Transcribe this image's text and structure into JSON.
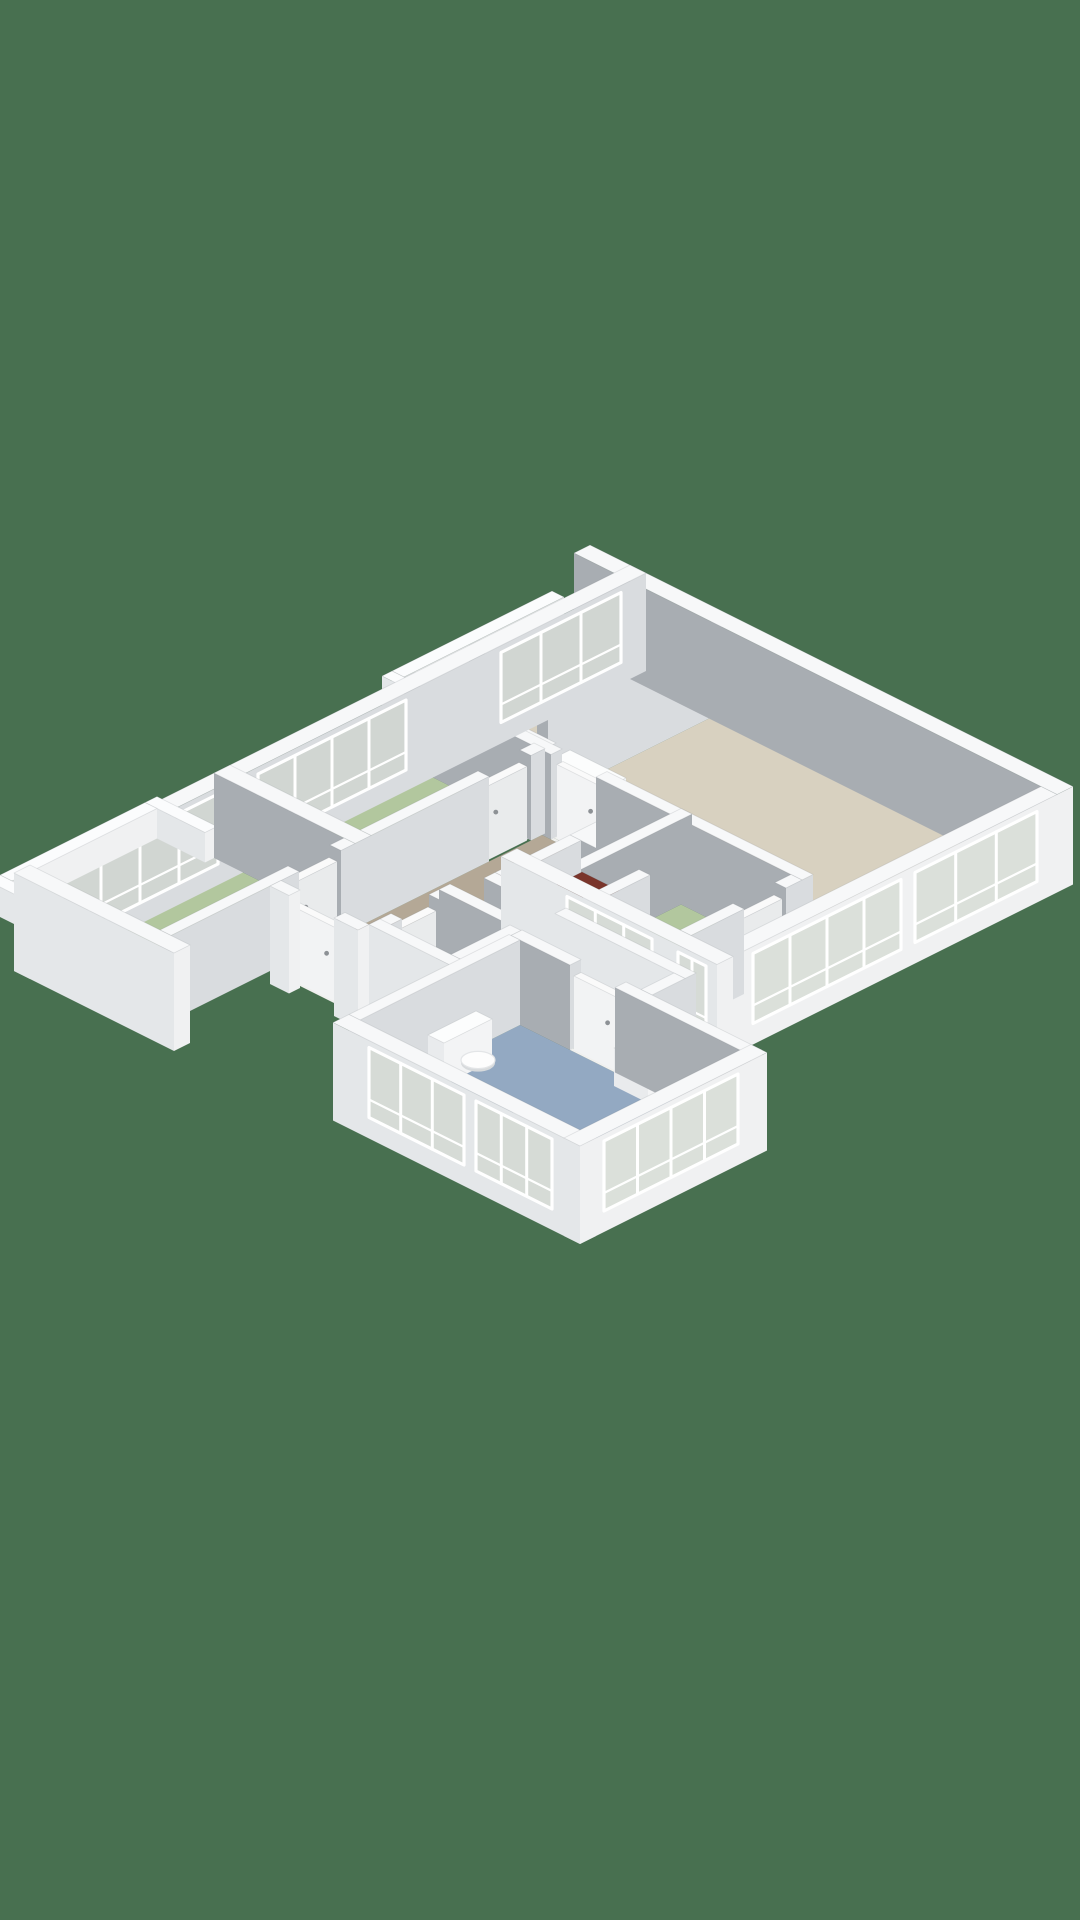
{
  "meta": {
    "type": "3d-isometric-floorplan-render",
    "description": "Top-down axonometric 3D floor plan of an apartment on a solid green background. No text labels are visible in the image."
  },
  "palette": {
    "background": "#487050",
    "floorBeige": "#d8d1c0",
    "floorTaupe": "#b4a896",
    "floorGreen": "#b2c79e",
    "floorBlue": "#93a9c2",
    "floorLight": "#e8e9e6",
    "floorTile": "#ecedeb",
    "tileLine": "#dcddda",
    "wallTop": "#f7f8f9",
    "wallGray": "#a8adb2",
    "wallIntU": "#d9dcdf",
    "wallExtV": "#e4e7e9",
    "wallExtU": "#f0f1f2",
    "railTop": "#fbfcfd",
    "glass": "rgba(202,210,199,0.55)",
    "frame": "#ffffff",
    "fixtureTop": "#fcfdfd",
    "fixtureV": "#e9ebed",
    "fixtureU": "#f3f4f5",
    "boilerTop": "#7a352b",
    "boilerV": "#662b22",
    "boilerU": "#57231b",
    "handle": "#8d9195",
    "threshold": "#f0f0ee",
    "capStroke": "rgba(90,95,100,0.15)"
  },
  "rooms": [
    {
      "name": "living-room",
      "floor": "floorBeige"
    },
    {
      "name": "kitchen",
      "floor": "floorBeige"
    },
    {
      "name": "hallway",
      "floor": "floorTaupe"
    },
    {
      "name": "bedroom-1-left-upper",
      "floor": "floorGreen"
    },
    {
      "name": "bedroom-2-left-lower",
      "floor": "floorGreen"
    },
    {
      "name": "bedroom-3-southeast",
      "floor": "floorGreen"
    },
    {
      "name": "bathroom",
      "floor": "floorBlue"
    },
    {
      "name": "wc",
      "floor": "floorLight"
    },
    {
      "name": "storage-closet-with-boiler",
      "floor": "floorLight"
    },
    {
      "name": "access-walkway-balcony",
      "floor": "floorTile"
    },
    {
      "name": "balcony",
      "floor": "floorTile"
    }
  ],
  "floorplan": {
    "projection": {
      "origin": [
        630,
        650
      ],
      "scale": 1,
      "wall_height": 85,
      "rail_height": 30,
      "slab_depth": -13
    },
    "floors": [
      {
        "name": "walkway-floor",
        "r": [
          -56,
          16,
          0,
          170
        ],
        "color": "floorTile",
        "tiled": true
      },
      {
        "name": "balcony-floor",
        "r": [
          -48,
          425,
          0,
          570
        ],
        "color": "floorTile",
        "tiled": true
      },
      {
        "name": "living-room-floor",
        "r": [
          108,
          16,
          427,
          218
        ],
        "color": "floorBeige"
      },
      {
        "name": "living-room-strip-floor",
        "r": [
          401,
          218,
          427,
          340
        ],
        "color": "floorBeige"
      },
      {
        "name": "kitchen-floor",
        "r": [
          16,
          16,
          97,
          150
        ],
        "color": "floorBeige"
      },
      {
        "name": "hall-upper-floor",
        "r": [
          16,
          161,
          97,
          215
        ],
        "color": "floorTaupe"
      },
      {
        "name": "hall-passage-floor",
        "r": [
          97,
          190,
          108,
          215
        ],
        "color": "floorTaupe"
      },
      {
        "name": "hall-main-floor",
        "r": [
          141,
          229,
          240,
          490
        ],
        "color": "floorTaupe"
      },
      {
        "name": "corridor-floor-a",
        "r": [
          240,
          386,
          311,
          409
        ],
        "color": "floorTaupe"
      },
      {
        "name": "corridor-floor-b",
        "r": [
          311,
          386,
          430,
          419
        ],
        "color": "floorTaupe"
      },
      {
        "name": "closet-floor",
        "r": [
          251,
          300,
          309,
          375
        ],
        "color": "floorLight"
      },
      {
        "name": "wc-floor",
        "r": [
          240,
          420,
          300,
          479
        ],
        "color": "floorLight"
      },
      {
        "name": "bathroom-floor",
        "r": [
          320,
          430,
          540,
          590
        ],
        "color": "floorBlue"
      },
      {
        "name": "bedroom-1-floor",
        "r": [
          16,
          226,
          130,
          400
        ],
        "color": "floorGreen"
      },
      {
        "name": "bedroom-2-floor",
        "r": [
          16,
          416,
          130,
          600
        ],
        "color": "floorGreen"
      },
      {
        "name": "bedroom-3-floor",
        "r": [
          280,
          229,
          390,
          340
        ],
        "color": "floorGreen"
      }
    ],
    "thresholds": [
      [
        25,
        150,
        85,
        161
      ],
      [
        150,
        218,
        195,
        229
      ],
      [
        401,
        218,
        427,
        229
      ],
      [
        160,
        490,
        205,
        501
      ],
      [
        370,
        419,
        415,
        430
      ],
      [
        229,
        430,
        240,
        468
      ],
      [
        130,
        240,
        141,
        282
      ],
      [
        130,
        430,
        141,
        472
      ],
      [
        390,
        245,
        401,
        287
      ],
      [
        262,
        375,
        300,
        386
      ]
    ],
    "walls": [
      {
        "name": "ne-facade-wall",
        "r": [
          -40,
          0,
          443,
          16
        ],
        "ext": true,
        "fv": "wallGray"
      },
      {
        "name": "se-facade-wall",
        "r": [
          427,
          16,
          443,
          340
        ],
        "ext": true,
        "win": [
          {
            "s": "u",
            "a": 36,
            "b": 158,
            "m": 2
          },
          {
            "s": "u",
            "a": 172,
            "b": 320,
            "m": 3
          }
        ]
      },
      {
        "name": "rightwing-south-wall",
        "r": [
          227,
          340,
          443,
          356
        ],
        "ext": true,
        "win": [
          {
            "s": "v",
            "a": 293,
            "b": 378,
            "m": 2
          },
          {
            "s": "v",
            "a": 404,
            "b": 432,
            "m": 1
          }
        ]
      },
      {
        "name": "nw-facade-wall",
        "r": [
          0,
          0,
          16,
          616
        ],
        "ext": true,
        "fu": "wallIntU",
        "win": [
          {
            "s": "u",
            "a": 25,
            "b": 145,
            "m": 2
          },
          {
            "s": "u",
            "a": 240,
            "b": 388,
            "m": 3
          },
          {
            "s": "u",
            "a": 428,
            "b": 584,
            "m": 3
          }
        ]
      },
      {
        "name": "leftwing-south-wall",
        "r": [
          0,
          600,
          160,
          616
        ],
        "ext": true
      },
      {
        "name": "bedroom2-east-wall-a",
        "r": [
          130,
          416,
          141,
          430
        ]
      },
      {
        "name": "bedroom2-east-wall-b",
        "r": [
          130,
          472,
          141,
          600
        ]
      },
      {
        "name": "bedroom1-east-wall-a",
        "r": [
          130,
          226,
          141,
          240
        ]
      },
      {
        "name": "bedroom1-east-wall-b",
        "r": [
          130,
          282,
          141,
          400
        ]
      },
      {
        "name": "bedroom1-north-wall",
        "r": [
          0,
          215,
          141,
          226
        ]
      },
      {
        "name": "bedrooms-divider-wall",
        "r": [
          0,
          400,
          141,
          416
        ]
      },
      {
        "name": "kitchen-divider-wall",
        "r": [
          97,
          16,
          108,
          150
        ]
      },
      {
        "name": "kitchen-south-wall-a",
        "r": [
          0,
          150,
          25,
          161
        ]
      },
      {
        "name": "kitchen-south-wall-b",
        "r": [
          85,
          150,
          108,
          161
        ]
      },
      {
        "name": "hall-stub-wall",
        "r": [
          97,
          161,
          108,
          190
        ]
      },
      {
        "name": "living-south-wall-a",
        "r": [
          97,
          218,
          150,
          229
        ]
      },
      {
        "name": "living-south-wall-b",
        "r": [
          195,
          218,
          401,
          229
        ]
      },
      {
        "name": "bedroom3-west-wall",
        "r": [
          269,
          218,
          280,
          340
        ],
        "fu": "wallGray"
      },
      {
        "name": "bedroom3-east-wall-a",
        "r": [
          390,
          229,
          401,
          245
        ]
      },
      {
        "name": "bedroom3-east-wall-b",
        "r": [
          390,
          287,
          401,
          340
        ]
      },
      {
        "name": "hall-block-wall",
        "r": [
          240,
          229,
          269,
          300
        ]
      },
      {
        "name": "closet-west-wall",
        "r": [
          240,
          300,
          251,
          375
        ]
      },
      {
        "name": "closet-east-wall",
        "r": [
          309,
          300,
          320,
          386
        ]
      },
      {
        "name": "closet-south-wall-a",
        "r": [
          240,
          375,
          262,
          386
        ]
      },
      {
        "name": "closet-south-wall-b",
        "r": [
          300,
          375,
          320,
          386
        ]
      },
      {
        "name": "wc-north-wall",
        "r": [
          229,
          409,
          311,
          420
        ]
      },
      {
        "name": "wc-west-wall-a",
        "r": [
          229,
          420,
          240,
          430
        ]
      },
      {
        "name": "wc-west-wall-b",
        "r": [
          229,
          468,
          240,
          490
        ]
      },
      {
        "name": "wc-east-wall",
        "r": [
          300,
          420,
          311,
          479
        ]
      },
      {
        "name": "wc-south-wall",
        "r": [
          229,
          479,
          311,
          490
        ],
        "ext": true
      },
      {
        "name": "entry-south-wall-a",
        "r": [
          141,
          490,
          160,
          501
        ],
        "ext": true
      },
      {
        "name": "entry-south-wall-b",
        "r": [
          205,
          490,
          229,
          501
        ],
        "ext": true
      },
      {
        "name": "bathroom-north-wall-a",
        "r": [
          311,
          419,
          370,
          430
        ]
      },
      {
        "name": "bathroom-north-wall-b",
        "r": [
          415,
          419,
          551,
          430
        ]
      },
      {
        "name": "corridor-east-wall",
        "r": [
          430,
          386,
          441,
          419
        ]
      },
      {
        "name": "corridor-north-wall",
        "r": [
          311,
          375,
          441,
          386
        ],
        "fv": "wallExtV"
      },
      {
        "name": "bathroom-east-wall",
        "r": [
          540,
          419,
          556,
          606
        ],
        "ext": true,
        "win": [
          {
            "s": "u",
            "a": 448,
            "b": 582,
            "m": 3
          }
        ]
      },
      {
        "name": "bathroom-south-wall",
        "r": [
          309,
          590,
          556,
          606
        ],
        "ext": true,
        "win": [
          {
            "s": "v",
            "a": 345,
            "b": 440,
            "m": 2
          },
          {
            "s": "v",
            "a": 452,
            "b": 528,
            "m": 2
          }
        ]
      },
      {
        "name": "bathroom-west-wall",
        "r": [
          309,
          430,
          320,
          590
        ]
      },
      {
        "name": "walkway-railing",
        "r": [
          -68,
          10,
          -56,
          170
        ],
        "h": 30,
        "rail": true
      },
      {
        "name": "walkway-railing-return",
        "r": [
          -68,
          170,
          -18,
          180
        ],
        "h": 30,
        "rail": true
      },
      {
        "name": "balcony-railing",
        "r": [
          -60,
          425,
          -48,
          570
        ],
        "h": 30,
        "rail": true
      },
      {
        "name": "balcony-railing-north",
        "r": [
          -60,
          413,
          0,
          425
        ],
        "h": 30,
        "rail": true
      },
      {
        "name": "balcony-railing-south",
        "r": [
          -60,
          570,
          -6,
          582
        ],
        "h": 30,
        "rail": true
      }
    ],
    "doors": [
      {
        "name": "door-living-hall",
        "r": [
          152,
          219,
          193,
          225
        ]
      },
      {
        "name": "door-bedroom1",
        "r": [
          131,
          242,
          139,
          280
        ]
      },
      {
        "name": "door-bedroom2",
        "r": [
          131,
          432,
          139,
          470
        ]
      },
      {
        "name": "door-bedroom3",
        "r": [
          391,
          247,
          399,
          285
        ]
      },
      {
        "name": "door-bathroom",
        "r": [
          372,
          421,
          413,
          428
        ]
      },
      {
        "name": "door-wc",
        "r": [
          230,
          432,
          238,
          466
        ]
      },
      {
        "name": "door-entry",
        "r": [
          162,
          492,
          203,
          499
        ]
      }
    ],
    "boxes": [
      {
        "name": "kitchen-counter",
        "r": [
          112,
          172,
          168,
          216
        ],
        "h": 42
      },
      {
        "name": "kitchen-counter-low",
        "r": [
          168,
          182,
          194,
          216
        ],
        "h": 20
      },
      {
        "name": "boiler-unit",
        "r": [
          254,
          302,
          306,
          330
        ],
        "h": 56,
        "c": "boiler"
      },
      {
        "name": "wc-cistern",
        "r": [
          286,
          436,
          299,
          464
        ],
        "h": 36
      },
      {
        "name": "bathroom-cistern",
        "r": [
          326,
          480,
          342,
          528
        ],
        "h": 42
      },
      {
        "name": "bathtub",
        "r": [
          430,
          540,
          535,
          586
        ],
        "h": 26
      },
      {
        "name": "washbasin-cabinet",
        "r": [
          428,
          432,
          462,
          444
        ],
        "h": 38
      },
      {
        "name": "washbasin2-cabinet",
        "r": [
          524,
          458,
          539,
          486
        ],
        "h": 34
      }
    ],
    "tub_inner": {
      "name": "bathtub-inner",
      "r": [
        437,
        547,
        528,
        580
      ],
      "z": 26
    },
    "ellipses": [
      {
        "name": "wc-toilet-bowl",
        "c": [
          276,
          450
        ],
        "rad": 11,
        "z": 20
      },
      {
        "name": "bathroom-toilet-bowl",
        "c": [
          352,
          504
        ],
        "rad": 12,
        "z": 18
      },
      {
        "name": "washbasin-bowl",
        "c": [
          445,
          438
        ],
        "rad": 8,
        "z": 38
      },
      {
        "name": "washbasin2-bowl",
        "c": [
          531,
          471
        ],
        "rad": 7,
        "z": 34
      },
      {
        "name": "floor-drain",
        "c": [
          498,
          562
        ],
        "rad": 3.5,
        "z": 1,
        "flat": true
      }
    ]
  }
}
